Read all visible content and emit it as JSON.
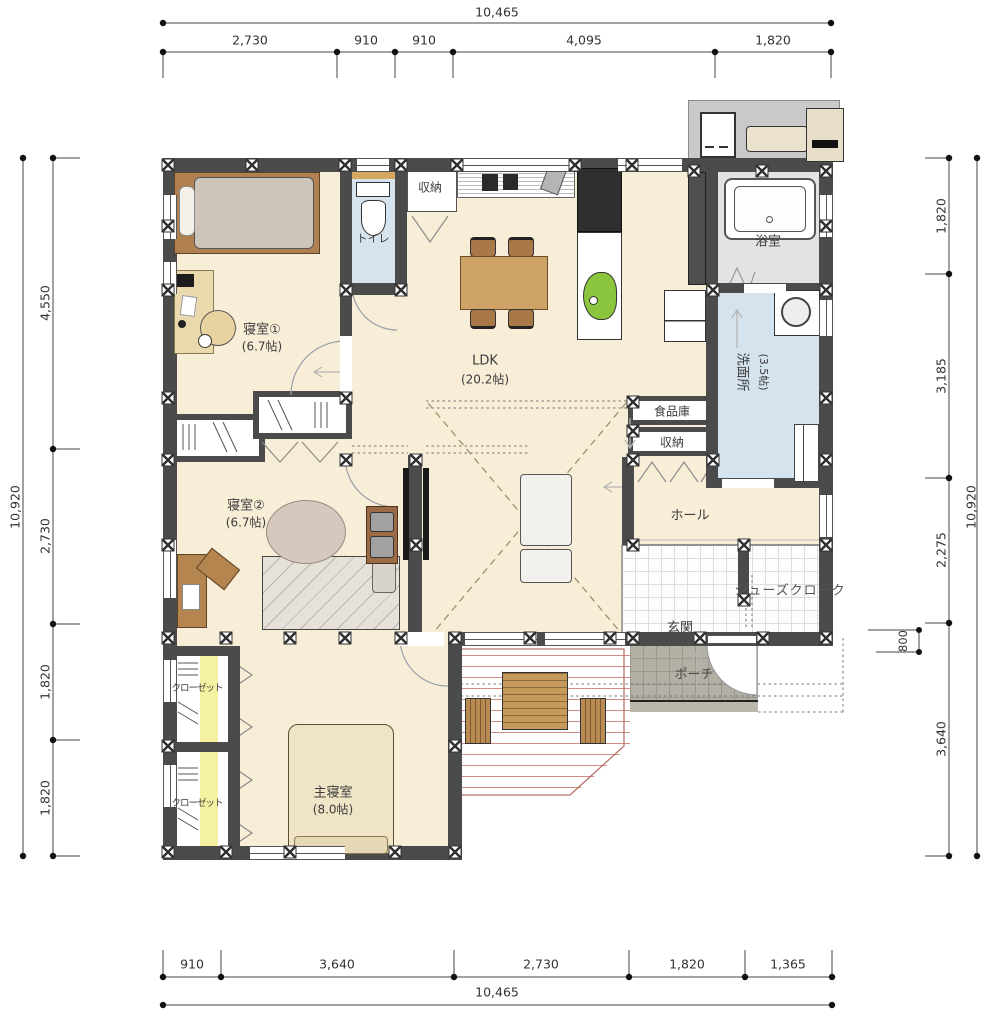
{
  "dimensions": {
    "top": {
      "total": "10,465",
      "segments": [
        "2,730",
        "910",
        "910",
        "4,095",
        "1,820"
      ]
    },
    "bottom": {
      "total": "10,465",
      "segments": [
        "910",
        "3,640",
        "2,730",
        "1,820",
        "1,365"
      ]
    },
    "left": {
      "total": "10,920",
      "segments": [
        "4,550",
        "2,730",
        "1,820",
        "1,820"
      ]
    },
    "right": {
      "total": "10,920",
      "segments": [
        "1,820",
        "3,185",
        "2,275",
        "3,640"
      ],
      "sub": "800"
    }
  },
  "rooms": {
    "bedroom1": {
      "name": "寝室①",
      "area": "(6.7帖)"
    },
    "toilet": {
      "name": "トイレ"
    },
    "storage_top": {
      "name": "収納"
    },
    "ldk": {
      "name": "LDK",
      "area": "(20.2帖)"
    },
    "bath": {
      "name": "浴室"
    },
    "washroom": {
      "name": "洗面所",
      "area": "(3.5帖)"
    },
    "pantry": {
      "name": "食品庫"
    },
    "storage_hall": {
      "name": "収納"
    },
    "hall": {
      "name": "ホール"
    },
    "genkan": {
      "name": "玄関"
    },
    "shoes_closet": {
      "name": "シューズクローク"
    },
    "porch": {
      "name": "ポーチ"
    },
    "bedroom2": {
      "name": "寝室②",
      "area": "(6.7帖)"
    },
    "closet_upper": {
      "name": "クローゼット"
    },
    "closet_lower": {
      "name": "クローゼット"
    },
    "master": {
      "name": "主寝室",
      "area": "(8.0帖)"
    }
  },
  "colors": {
    "wall": "#4b4b4b",
    "floor": "#f8eed8",
    "wet_area": "#d5e3ee",
    "closet_mat": "#f4f1a0",
    "kitchen_sink": "#8cc63f",
    "deck_line": "#cf8d84",
    "porch": "#b3b0a6"
  }
}
